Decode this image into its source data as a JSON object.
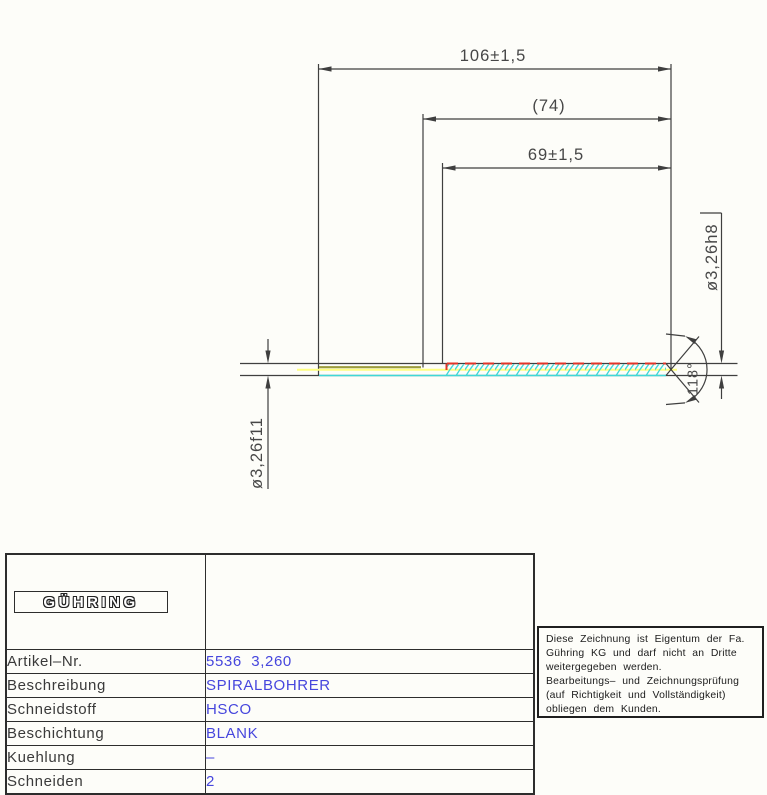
{
  "drawing": {
    "dim_total_length": "106±1,5",
    "dim_to_flute_end": "(74)",
    "dim_flute_length": "69±1,5",
    "dim_tip_diameter": "ø3,26h8",
    "dim_shank_diameter": "ø3,26f11",
    "point_angle": "118°"
  },
  "table": {
    "logo": "GÜHRING",
    "rows": [
      {
        "label": "Artikel–Nr.",
        "value": "5536  3,260"
      },
      {
        "label": "Beschreibung",
        "value": "SPIRALBOHRER"
      },
      {
        "label": "Schneidstoff",
        "value": "HSCO"
      },
      {
        "label": "Beschichtung",
        "value": "BLANK"
      },
      {
        "label": "Kuehlung",
        "value": "–"
      },
      {
        "label": "Schneiden",
        "value": "2"
      }
    ]
  },
  "notice": {
    "lines": [
      "Diese Zeichnung ist Eigentum der Fa.",
      "Gühring KG und darf nicht an Dritte",
      "weitergegeben werden.",
      "Bearbeitungs– und Zeichnungsprüfung",
      "(auf Richtigkeit und Vollständigkeit)",
      "obliegen dem Kunden."
    ]
  },
  "colors": {
    "flute_cyan": "#40d8d8",
    "centerline_yellow": "#ffff80",
    "flute_margin_red": "#e23528",
    "shank_ground_olive": "#9b9b3d",
    "value_blue": "#4646dd",
    "line_gray": "#3f3f3f"
  }
}
